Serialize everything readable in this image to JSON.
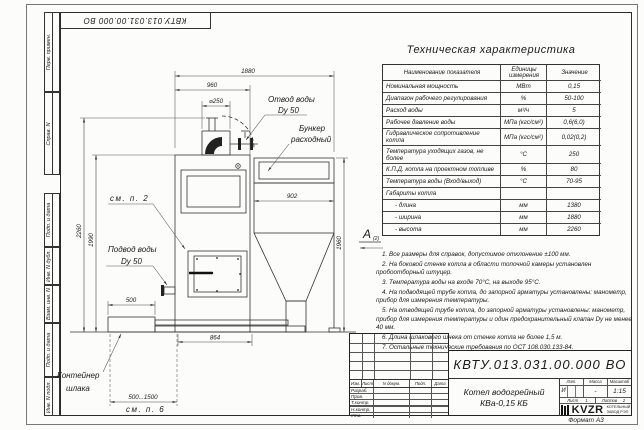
{
  "margin": {
    "top_labels": [
      "Перв. примен.",
      "Справ. N"
    ],
    "bottom_labels": [
      "Подп. и дата",
      "Инв. N дубл.",
      "Взам. инв. N",
      "Подп. и дата",
      "Инв. N подл."
    ]
  },
  "tech_table": {
    "title": "Техническая характеристика",
    "col_name": "Наименование показателя",
    "col_units": "Единицы измерения",
    "col_value": "Значение",
    "rows": [
      {
        "name": "Номинальная мощность",
        "units": "МВт",
        "value": "0,15"
      },
      {
        "name": "Диапазон рабочего регулирования",
        "units": "%",
        "value": "50-100"
      },
      {
        "name": "Расход воды",
        "units": "м³/ч",
        "value": "5"
      },
      {
        "name": "Рабочее давление воды",
        "units": "МПа (кгс/см²)",
        "value": "0,6(6,0)"
      },
      {
        "name": "Гидравлическое сопротивление котла",
        "units": "МПа (кгс/см²)",
        "value": "0,02(0,2)"
      },
      {
        "name": "Температура уходящих газов, не более",
        "units": "°С",
        "value": "250"
      },
      {
        "name": "К.П.Д. котла на проектном топливе",
        "units": "%",
        "value": "80"
      },
      {
        "name": "Температура воды (Вход/выход)",
        "units": "°С",
        "value": "70-95"
      },
      {
        "name": "Габариты котла",
        "units": "",
        "value": ""
      },
      {
        "name": "- длина",
        "units": "мм",
        "value": "1380"
      },
      {
        "name": "- ширина",
        "units": "мм",
        "value": "1880"
      },
      {
        "name": "- высота",
        "units": "мм",
        "value": "2260"
      }
    ]
  },
  "notes": [
    "1. Все размеры для справок, допустимое отклонение ±100 мм.",
    "2. На боковой стенке котла в области топочной камеры установлен пробоотборный штуцер.",
    "3. Температура воды на входе 70°С, на выходе 95°С.",
    "4. На подводящей трубе котла, до запорной арматуры установлены: манометр, прибор для измерения температуры.",
    "5. На отводящей трубе котла, до запорной арматуры установлены: манометр, прибор для измерения температуры и один предохранительный клапан Dу не менее 40 мм.",
    "6. Длина шлакового шнека от стенке котла не более 1,5 м.",
    "7. Остальные технические требования по ОСТ 108.030.133-84."
  ],
  "view_a": {
    "letter": "А",
    "ref": "(2)"
  },
  "drawing": {
    "labels": {
      "water_outlet_1": "Отвод воды",
      "water_outlet_2": "Dy 50",
      "hopper_1": "Бункер",
      "hopper_2": "расходный",
      "water_inlet_1": "Подвод воды",
      "water_inlet_2": "Dy 50",
      "slag_1": "Контейнер",
      "slag_2": "шлака",
      "see_item_2": "см. п. 2",
      "see_item_6": "см. п. 6"
    },
    "dims": {
      "overall_width": "1880",
      "boiler_depth": "960",
      "chimney_dia": "⌀250",
      "hopper_width": "902",
      "hopper_height": "1960",
      "overall_height": "2260",
      "boiler_height": "1990",
      "container_width": "500",
      "container_travel": "500...1500",
      "screw_length": "864"
    }
  },
  "title_block": {
    "doc_number": "КВТУ.013.031.00.000  ВО",
    "change_headers": [
      "Изм.",
      "Лист",
      "N докум.",
      "Подп.",
      "Дата"
    ],
    "sign_rows": [
      "Разраб.",
      "Пров.",
      "Т.контр.",
      "Н.контр.",
      "Утв."
    ],
    "product_name": "Котел водогрейный КВа-0,15 КБ",
    "lit_header": "Лит.",
    "mass_header": "Масса",
    "scale_header": "Масштаб",
    "lit": "И",
    "mass": "-",
    "scale": "1:15",
    "sheet_label": "Лист",
    "sheet_number": "1",
    "sheets_label": "Листов",
    "sheets_total": "2",
    "company_logo": "KVZR",
    "company_line1": "КОТЕЛЬНЫЙ",
    "company_line2": "ЗАВОД РЭП",
    "format_note": "Формат А3"
  }
}
